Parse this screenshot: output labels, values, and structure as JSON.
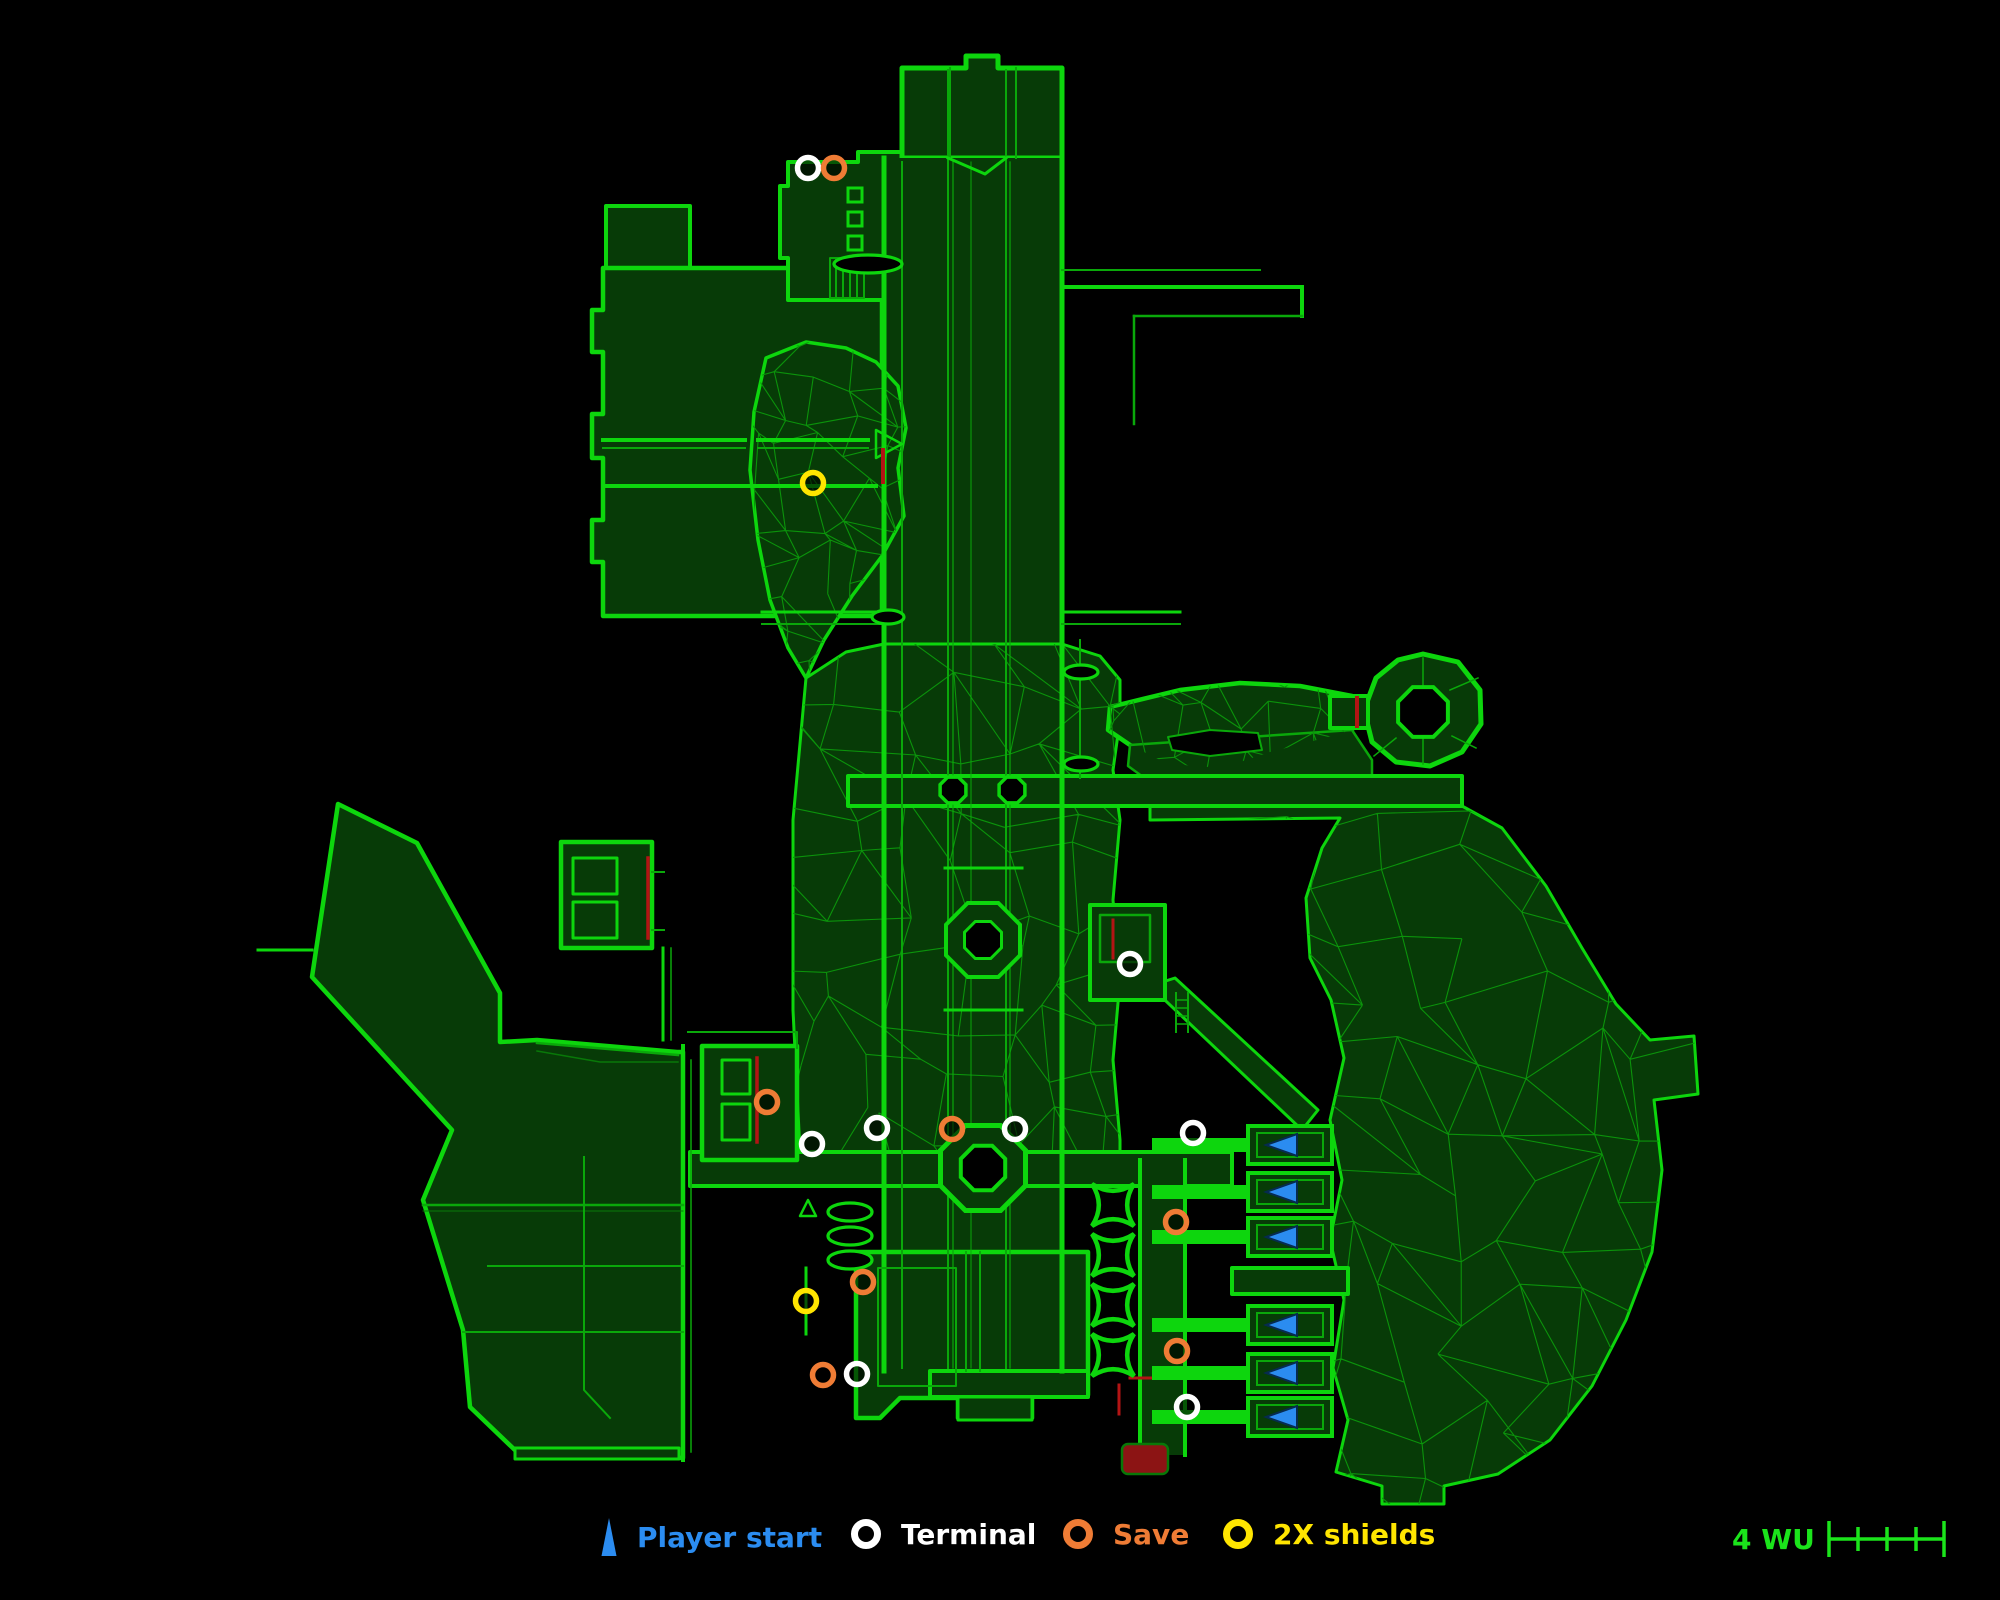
{
  "legend": {
    "items": [
      {
        "id": "player-start",
        "label": "Player start",
        "color": "#2B8CF0",
        "icon": "triangle",
        "left": 598
      },
      {
        "id": "terminal",
        "label": "Terminal",
        "color": "#FFFFFF",
        "icon": "circle",
        "left": 848
      },
      {
        "id": "save",
        "label": "Save",
        "color": "#EF7C35",
        "icon": "circle",
        "left": 1060
      },
      {
        "id": "shields",
        "label": "2X shields",
        "color": "#FFE500",
        "icon": "circle",
        "left": 1220
      }
    ],
    "scale": {
      "label": "4 WU",
      "segments": 4,
      "color": "#1BE41B",
      "left": 1732
    }
  },
  "map": {
    "colors": {
      "bg": "#000000",
      "fill": "#073B07",
      "bright": "#0DD60D",
      "mid": "#0AA80A",
      "dim": "#087808",
      "mesh": "#0B930B",
      "red": "#B31414",
      "maroon": "#8C1414",
      "blue": "#2B8CF0",
      "blue_dark": "#062B4F",
      "white": "#FFFFFF",
      "orange": "#EF7C35",
      "yellow": "#FFE500"
    },
    "marker_style": {
      "r": 10.5,
      "stroke_width": 5.5
    },
    "markers": {
      "terminals": [
        [
          808,
          168
        ],
        [
          1130,
          964
        ],
        [
          812,
          1144
        ],
        [
          877,
          1128
        ],
        [
          1015,
          1129
        ],
        [
          1193,
          1133
        ],
        [
          857,
          1374
        ],
        [
          1187,
          1407
        ]
      ],
      "saves": [
        [
          834,
          168
        ],
        [
          767,
          1102
        ],
        [
          952,
          1129
        ],
        [
          1176,
          1222
        ],
        [
          863,
          1282
        ],
        [
          823,
          1375
        ],
        [
          1177,
          1351
        ]
      ],
      "shields": [
        [
          813,
          483
        ],
        [
          806,
          1301
        ]
      ],
      "red_zone": {
        "x": 1122,
        "y": 1444,
        "w": 46,
        "h": 30
      }
    },
    "bays": {
      "ys": [
        1145,
        1192,
        1237,
        1325,
        1373,
        1417
      ]
    },
    "cushions": {
      "cx": 1113,
      "cys": [
        1205,
        1255,
        1305,
        1355
      ],
      "r": 21
    },
    "rings": [
      {
        "cx": 953,
        "cy": 790,
        "ro": 14,
        "w": 3.5
      },
      {
        "cx": 1012,
        "cy": 790,
        "ro": 14,
        "w": 3.5
      },
      {
        "cx": 983,
        "cy": 940,
        "ro": 40,
        "ri": 20,
        "w": 4
      },
      {
        "cx": 983,
        "cy": 1168,
        "ro": 46,
        "ri": 24,
        "w": 5
      },
      {
        "cx": 1423,
        "cy": 712,
        "ro": 27,
        "w": 4
      }
    ],
    "ovals": [
      {
        "cx": 888,
        "cy": 617,
        "rx": 16,
        "ry": 7
      },
      {
        "cx": 1081,
        "cy": 672,
        "rx": 17,
        "ry": 7
      },
      {
        "cx": 1081,
        "cy": 764,
        "rx": 17,
        "ry": 7
      },
      {
        "cx": 868,
        "cy": 264,
        "rx": 34,
        "ry": 9
      },
      {
        "cx": 850,
        "cy": 1212,
        "rx": 22,
        "ry": 9
      },
      {
        "cx": 850,
        "cy": 1236,
        "rx": 22,
        "ry": 9
      },
      {
        "cx": 850,
        "cy": 1260,
        "rx": 22,
        "ry": 9
      }
    ],
    "dash_rects": [
      [
        848,
        188,
        14,
        14
      ],
      [
        848,
        212,
        14,
        14
      ],
      [
        848,
        236,
        14,
        14
      ]
    ],
    "fills": {
      "left-landmass": {
        "d": "M338,804 L417,843 L500,993 L500,1042 L537,1040 L677,1052 L683,1052 L683,1458 L517,1452 L470,1407 L463,1330 L423,1200 L452,1130 L312,977 Z",
        "w": 4.5
      },
      "top-left-upper": {
        "d": "M606,206 L690,206 L690,268 L606,268 Z",
        "w": 4
      },
      "top-left-block": {
        "d": "M603,268 L882,268 L882,616 L603,616 L603,562 L592,562 L592,520 L603,520 L603,458 L592,458 L592,414 L603,414 L603,352 L592,352 L592,310 L603,310 Z",
        "w": 4.5
      },
      "top-mid": {
        "d": "M788,162 L858,162 L858,152 L902,152 L902,300 L788,300 L788,258 L780,258 L780,186 L788,186 Z",
        "w": 4
      },
      "top-room": {
        "d": "M902,158 L902,68 L966,68 L966,56 L998,56 L998,68 L1062,68 L1062,158 Z",
        "w": 5
      },
      "trunk": {
        "d": "M884,158 L1062,158 L1062,1371 L884,1371 Z",
        "w": 0
      },
      "cave": {
        "d": "M766,358 L806,342 L846,348 L876,362 L898,386 L906,428 L898,468 L904,516 L882,556 L852,596 L824,640 L806,678 L788,648 L770,600 L758,540 L750,470 L754,412 Z",
        "w": 3.5
      },
      "surround": {
        "d": "M806,678 L846,652 L884,644 L1062,644 L1100,656 L1120,680 L1120,720 L1113,770 L1120,820 L1113,900 L1120,980 L1113,1060 L1120,1140 L1120,1152 L800,1152 L793,1010 L793,820 Z",
        "w": 3
      },
      "wavy": {
        "d": "M1108,730 L1110,707 L1180,690 L1240,683 L1300,686 L1352,696 L1352,730 L1310,742 L1270,752 L1240,762 L1200,768 L1160,760 L1130,745 Z",
        "w": 4.5
      },
      "wavy-lower": {
        "d": "M1130,745 L1352,730 L1372,760 L1372,782 L1150,782 L1128,766 Z",
        "w": 2.5,
        "stroke": "mid"
      },
      "east-landmass": {
        "d": "M1150,806 L1462,806 L1502,828 L1546,886 L1582,948 L1616,1004 L1650,1040 L1694,1036 L1698,1094 L1654,1100 L1662,1170 L1652,1252 L1626,1320 L1592,1386 L1550,1440 L1498,1474 L1444,1486 L1444,1504 L1382,1504 L1382,1486 L1336,1472 L1348,1420 L1333,1368 L1344,1300 L1330,1240 L1342,1180 L1330,1120 L1344,1058 L1331,1000 L1310,958 L1306,898 L1322,848 L1340,818 L1150,820 Z",
        "w": 3
      },
      "wavy-hole": {
        "d": "M1168,737 L1210,730 L1258,733 L1262,750 L1210,756 L1172,750 Z",
        "w": 2,
        "fill": "bg",
        "stroke": "mid"
      },
      "h1-corridor": {
        "d": "M848,776 L1462,776 L1462,806 L848,806 Z",
        "w": 4
      },
      "ring-outer": {
        "d": "M1423,654 L1458,662 L1480,690 L1481,724 L1462,752 L1430,766 L1396,762 L1372,742 L1364,710 L1376,678 L1398,660 Z",
        "w": 5
      },
      "ring-stub": {
        "d": "M1330,696 L1368,696 L1368,728 L1330,728 Z",
        "w": 4
      },
      "diag-corridor": {
        "d": "M1150,986 L1175,978 L1318,1110 L1302,1130 Z",
        "w": 3
      },
      "h2-corridor": {
        "d": "M690,1152 L1232,1152 L1232,1186 L690,1186 Z",
        "w": 4
      },
      "complex-a": {
        "d": "M561,842 L652,842 L652,948 L561,948 Z",
        "w": 4.5
      },
      "complex-b": {
        "d": "M702,1046 L797,1046 L797,1160 L702,1160 Z",
        "w": 4.5
      },
      "trunk-east-rooms": {
        "d": "M1090,905 L1165,905 L1165,1000 L1090,1000 Z",
        "w": 4
      },
      "right-corridor": {
        "d": "M1140,1160 L1185,1160 L1185,1455 L1140,1455 Z",
        "w": 0
      },
      "bottom-center": {
        "d": "M856,1252 L1088,1252 L1088,1395 L1032,1395 L1032,1418 L958,1418 L958,1398 L900,1398 L880,1418 L856,1418 Z",
        "w": 4.5
      },
      "trunk-bottom-bar": {
        "d": "M930,1371 L1088,1371 L1088,1397 L930,1397 Z",
        "w": 4
      },
      "bottom-tab": {
        "d": "M958,1397 L1032,1397 L1032,1420 L958,1420 Z",
        "w": 3
      },
      "left-bottom-bar": {
        "d": "M515,1448 L679,1448 L679,1459 L515,1459 Z",
        "w": 3
      },
      "bay-cross-band": {
        "d": "M1232,1268 L1348,1268 L1348,1294 L1232,1294 Z",
        "w": 4
      }
    },
    "fill_order": [
      "left-landmass",
      "top-left-upper",
      "top-left-block",
      "top-mid",
      "top-room",
      "trunk",
      "cave",
      "surround",
      "wavy",
      "wavy-lower",
      "east-landmass"
    ],
    "post_fill_order": [
      "wavy-hole",
      "h1-corridor",
      "ring-outer",
      "ring-stub",
      "diag-corridor",
      "h2-corridor",
      "complex-a",
      "complex-b",
      "trunk-east-rooms",
      "right-corridor",
      "bottom-center",
      "trunk-bottom-bar",
      "bottom-tab",
      "left-bottom-bar",
      "bay-cross-band"
    ],
    "meshes": [
      {
        "use": "cave",
        "bbox": [
          748,
          340,
          160,
          340
        ],
        "cell": 36,
        "seed": 7
      },
      {
        "use": "surround",
        "bbox": [
          790,
          642,
          332,
          512
        ],
        "cell": 54,
        "seed": 3
      },
      {
        "use": "east-landmass",
        "bbox": [
          1150,
          806,
          550,
          700
        ],
        "cell": 62,
        "seed": 9
      },
      {
        "use": "wavy",
        "bbox": [
          1106,
          680,
          250,
          104
        ],
        "cell": 34,
        "seed": 5
      }
    ],
    "lines": [
      [
        "M884,158 L884,1371",
        "bright",
        5
      ],
      [
        "M1062,158 L1062,1371",
        "bright",
        5
      ],
      [
        "M902,162 L902,1368",
        "mid",
        2
      ],
      [
        "M948,70 L948,1368",
        "mid",
        2
      ],
      [
        "M953,162 L953,1368",
        "mid",
        1.2
      ],
      [
        "M971,162 L971,1368",
        "mid",
        1
      ],
      [
        "M1006,70 L1006,1368",
        "mid",
        2
      ],
      [
        "M1010,162 L1010,1368",
        "mid",
        1.2
      ],
      [
        "M1080,640 L1080,778",
        "mid",
        2
      ],
      [
        "M950,68 L950,158",
        "mid",
        2
      ],
      [
        "M1016,68 L1016,158",
        "mid",
        2
      ],
      [
        "M948,158 L985,174 L1006,158",
        "bright",
        3
      ],
      [
        "M603,440 L745,440",
        "bright",
        4
      ],
      [
        "M603,448 L745,448",
        "mid",
        2
      ],
      [
        "M758,440 L868,440",
        "bright",
        4
      ],
      [
        "M758,448 L868,448",
        "mid",
        2
      ],
      [
        "M603,486 L876,486",
        "bright",
        4
      ],
      [
        "M876,430 L902,444 L876,458 Z",
        "bright",
        2.5
      ],
      [
        "M830,258 L864,258 L864,298 L830,298 Z",
        "mid",
        2
      ],
      [
        "M836,260 L836,296",
        "mid",
        2
      ],
      [
        "M843,260 L843,296",
        "mid",
        2
      ],
      [
        "M850,260 L850,296",
        "mid",
        2
      ],
      [
        "M857,260 L857,296",
        "mid",
        2
      ],
      [
        "M1062,287 L1302,287",
        "bright",
        4
      ],
      [
        "M1302,287 L1302,316",
        "bright",
        4
      ],
      [
        "M1302,316 L1134,316",
        "mid",
        2.5
      ],
      [
        "M1134,316 L1134,424",
        "mid",
        2.5
      ],
      [
        "M1062,270 L1260,270",
        "mid",
        2
      ],
      [
        "M762,612 L884,612",
        "bright",
        3
      ],
      [
        "M762,624 L884,624",
        "mid",
        2
      ],
      [
        "M1062,612 L1180,612",
        "bright",
        3
      ],
      [
        "M1062,624 L1180,624",
        "mid",
        2
      ],
      [
        "M648,858 L648,938",
        "red",
        3.5
      ],
      [
        "M652,872 L664,872",
        "mid",
        2
      ],
      [
        "M652,930 L664,930",
        "mid",
        2
      ],
      [
        "M663,948 L663,1040",
        "bright",
        3
      ],
      [
        "M671,948 L671,1040",
        "mid",
        1.5
      ],
      [
        "M573,858 L617,858 L617,894 L573,894 Z",
        "bright",
        3
      ],
      [
        "M573,902 L617,902 L617,938 L573,938 Z",
        "bright",
        3
      ],
      [
        "M722,1060 L750,1060 L750,1094 L722,1094 Z",
        "bright",
        3
      ],
      [
        "M722,1104 L750,1104 L750,1140 L722,1140 Z",
        "bright",
        3
      ],
      [
        "M757,1058 L757,1142",
        "red",
        3.5
      ],
      [
        "M688,1032 L797,1032 L797,1048",
        "mid",
        2
      ],
      [
        "M683,1046 L683,1460",
        "bright",
        4
      ],
      [
        "M691,1060 L691,1452",
        "mid",
        1.5
      ],
      [
        "M1100,915 L1150,915 L1150,962 L1100,962 Z",
        "mid",
        2.5
      ],
      [
        "M1113,920 L1113,958",
        "red",
        3
      ],
      [
        "M1176,993 L1176,1032",
        "mid",
        2
      ],
      [
        "M1188,993 L1188,1032",
        "mid",
        2
      ],
      [
        "M1176,1000 L1188,1000",
        "mid",
        1.5
      ],
      [
        "M1176,1008 L1188,1008",
        "mid",
        1.5
      ],
      [
        "M1176,1016 L1188,1016",
        "mid",
        1.5
      ],
      [
        "M1176,1024 L1188,1024",
        "mid",
        1.5
      ],
      [
        "M1140,1160 L1140,1455",
        "bright",
        4
      ],
      [
        "M1185,1160 L1185,1455",
        "bright",
        4
      ],
      [
        "M1130,1378 L1162,1378",
        "red",
        3
      ],
      [
        "M1119,1385 L1119,1414",
        "red",
        3
      ],
      [
        "M878,1268 L956,1268 L956,1386 L878,1386 Z",
        "mid",
        2
      ],
      [
        "M966,1252 L966,1371",
        "mid",
        2
      ],
      [
        "M980,1252 L980,1371",
        "mid",
        2
      ],
      [
        "M423,1205 L683,1205",
        "mid",
        2.5
      ],
      [
        "M423,1211 L683,1211",
        "dim",
        1
      ],
      [
        "M488,1266 L683,1266",
        "mid",
        2
      ],
      [
        "M463,1332 L683,1332",
        "mid",
        2
      ],
      [
        "M584,1157 L584,1390 L610,1418",
        "mid",
        2
      ],
      [
        "M537,1043 L678,1055",
        "mid",
        2.5
      ],
      [
        "M537,1051 L600,1062 L678,1062",
        "dim",
        1.5
      ],
      [
        "M258,950 L312,950",
        "bright",
        3
      ],
      [
        "M806,1268 L806,1334",
        "bright",
        3
      ],
      [
        "M800,1216 L808,1200 L816,1216 Z",
        "bright",
        2.5
      ],
      [
        "M945,868 L1022,868",
        "bright",
        3
      ],
      [
        "M945,1010 L1022,1010",
        "bright",
        3
      ],
      [
        "M1357,698 L1357,726",
        "red",
        4
      ],
      [
        "M883,450 L883,482",
        "red",
        4
      ],
      [
        "M1423,658 L1423,685",
        "mid",
        1.5
      ],
      [
        "M1423,739 L1423,764",
        "mid",
        1.5
      ],
      [
        "M1450,690 L1478,678",
        "mid",
        1.5
      ],
      [
        "M1452,736 L1476,748",
        "mid",
        1.5
      ],
      [
        "M1396,738 L1374,756",
        "mid",
        1.5
      ]
    ]
  }
}
